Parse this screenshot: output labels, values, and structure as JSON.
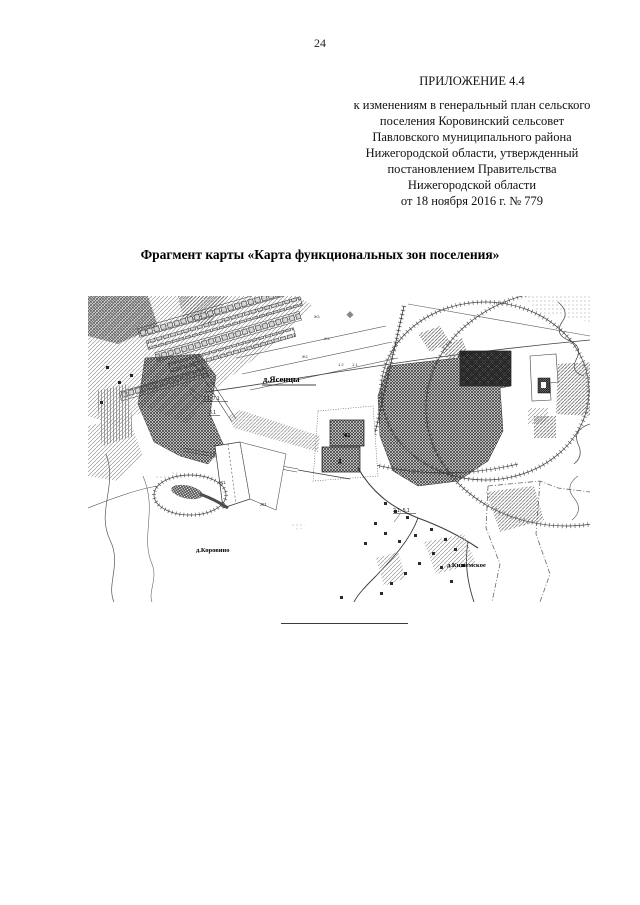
{
  "page": {
    "number": "24"
  },
  "header": {
    "appendix_title": "ПРИЛОЖЕНИЕ 4.4",
    "lines": [
      "к изменениям в генеральный план сельского",
      "поселения Коровинский сельсовет",
      "Павловского муниципального района",
      "Нижегородской области, утвержденный",
      "постановлением Правительства",
      "Нижегородской области",
      "от 18 ноября 2016 г. № 779"
    ]
  },
  "figure": {
    "title": "Фрагмент карты «Карта функциональных зон поселения»"
  },
  "map": {
    "settlements": {
      "yasentsy": "д.Ясенцы",
      "korovino": "д.Коровино",
      "kishemskoe": "д.Кишемское"
    },
    "zones": {
      "pair1": "2.1, 7.1",
      "z31": "3.1",
      "pair2": "2.1, 5.1",
      "zh1": "Ж1",
      "upper_sq": "Ж1",
      "lower_sq": "Д",
      "p12": "1.2",
      "p11": "1.1"
    },
    "colors": {
      "ink": "#1a1a1a",
      "hatch_light": "#9a9a9a",
      "hatch_dark": "#3c3c3c"
    }
  }
}
